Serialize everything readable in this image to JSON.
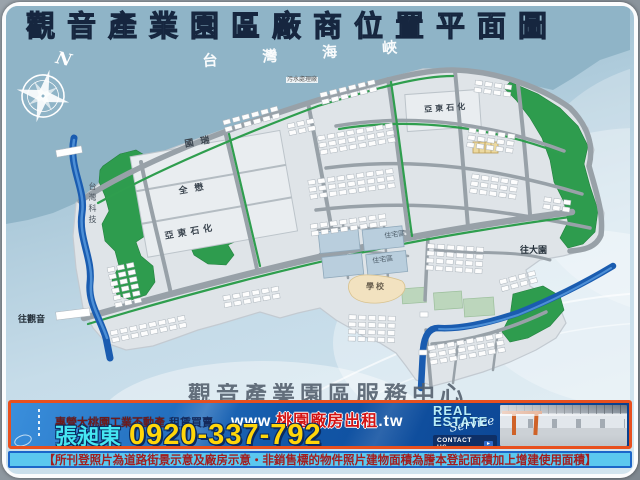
{
  "title": "觀音產業園區廠商位置平面圖",
  "map": {
    "sea_name": "台灣海峽",
    "compass": "N",
    "companies": {
      "guorui": "國瑞",
      "quanmao": "全懋",
      "yadong_large": "亞東石化",
      "yadong_west": "亞東石化",
      "taiwan_tech": "台灣科技",
      "sewage_plant": "污水處理廠"
    },
    "zones": {
      "school": "學校",
      "residential_a": "住宅區",
      "residential_b": "住宅區"
    },
    "directions": {
      "to_guanyin": "往觀音",
      "to_dayuan": "往大園"
    },
    "watermark": "觀音產業園區服務中心"
  },
  "banner": {
    "tagline_main": "專營大桃園工業不動產",
    "tagline_sub": "租賃買賣",
    "url_prefix": "www.",
    "url_domain": "桃園廠房出租",
    "url_suffix": ".tw",
    "agent_name": "張昶東",
    "phone": "0920-337-792",
    "brand_line1": "REAL",
    "brand_line2": "ESTATE",
    "brand_script": "Service",
    "contact_button": "CONTACT US"
  },
  "disclaimer": "【所刊登照片為道路街景示意及廠房示意‧非銷售標的物件照片建物面積為謄本登記面積加上增建使用面積】",
  "colors": {
    "sea": "#8fb4c7",
    "land": "#dfe4e8",
    "road": "#98a1a8",
    "park-green": "#2e9c4e",
    "river-blue": "#1a5cb0",
    "residential": "#b9cedd",
    "school-tan": "#f2e2c0",
    "banner-blue": "#1257a8",
    "banner-border": "#e8501e",
    "phone-yellow": "#ffd60a",
    "name-cyan": "#45e6f2",
    "url-red": "#d41414",
    "disclaimer-bg": "#5bc8ef",
    "disclaimer-text": "#a31d1f"
  }
}
